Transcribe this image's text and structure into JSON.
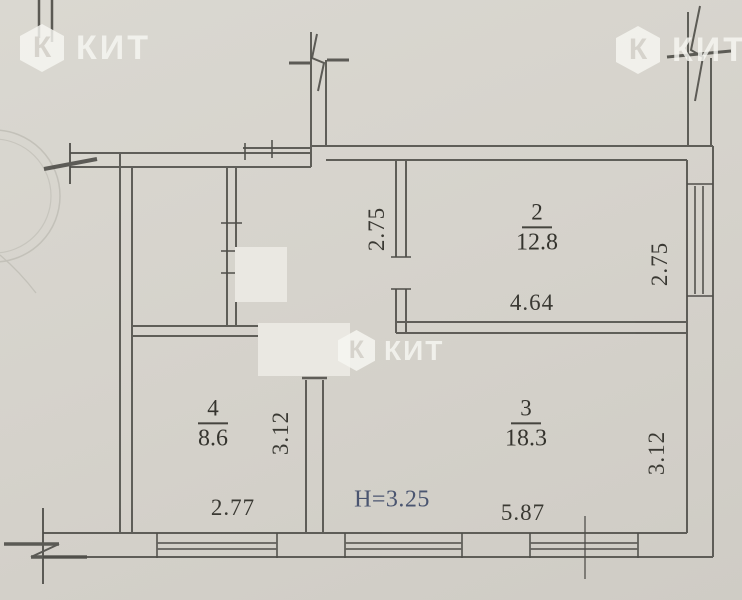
{
  "brand": {
    "watermark_text": "КИТ",
    "logo_letter": "К"
  },
  "plan": {
    "ceiling_height_label": "H=3.25",
    "rooms": [
      {
        "number": "2",
        "area": "12.8",
        "dim_bottom": "4.64",
        "dim_side": "2.75"
      },
      {
        "number": "3",
        "area": "18.3",
        "dim_bottom": "5.87",
        "dim_side": "3.12"
      },
      {
        "number": "4",
        "area": "8.6",
        "dim_bottom": "2.77",
        "dim_side": "3.12"
      }
    ],
    "hall": {
      "dim_side": "2.75"
    }
  },
  "colors": {
    "ink": "#4f4e49",
    "paper": "#d6d3cc",
    "height_text": "#4a5570"
  }
}
